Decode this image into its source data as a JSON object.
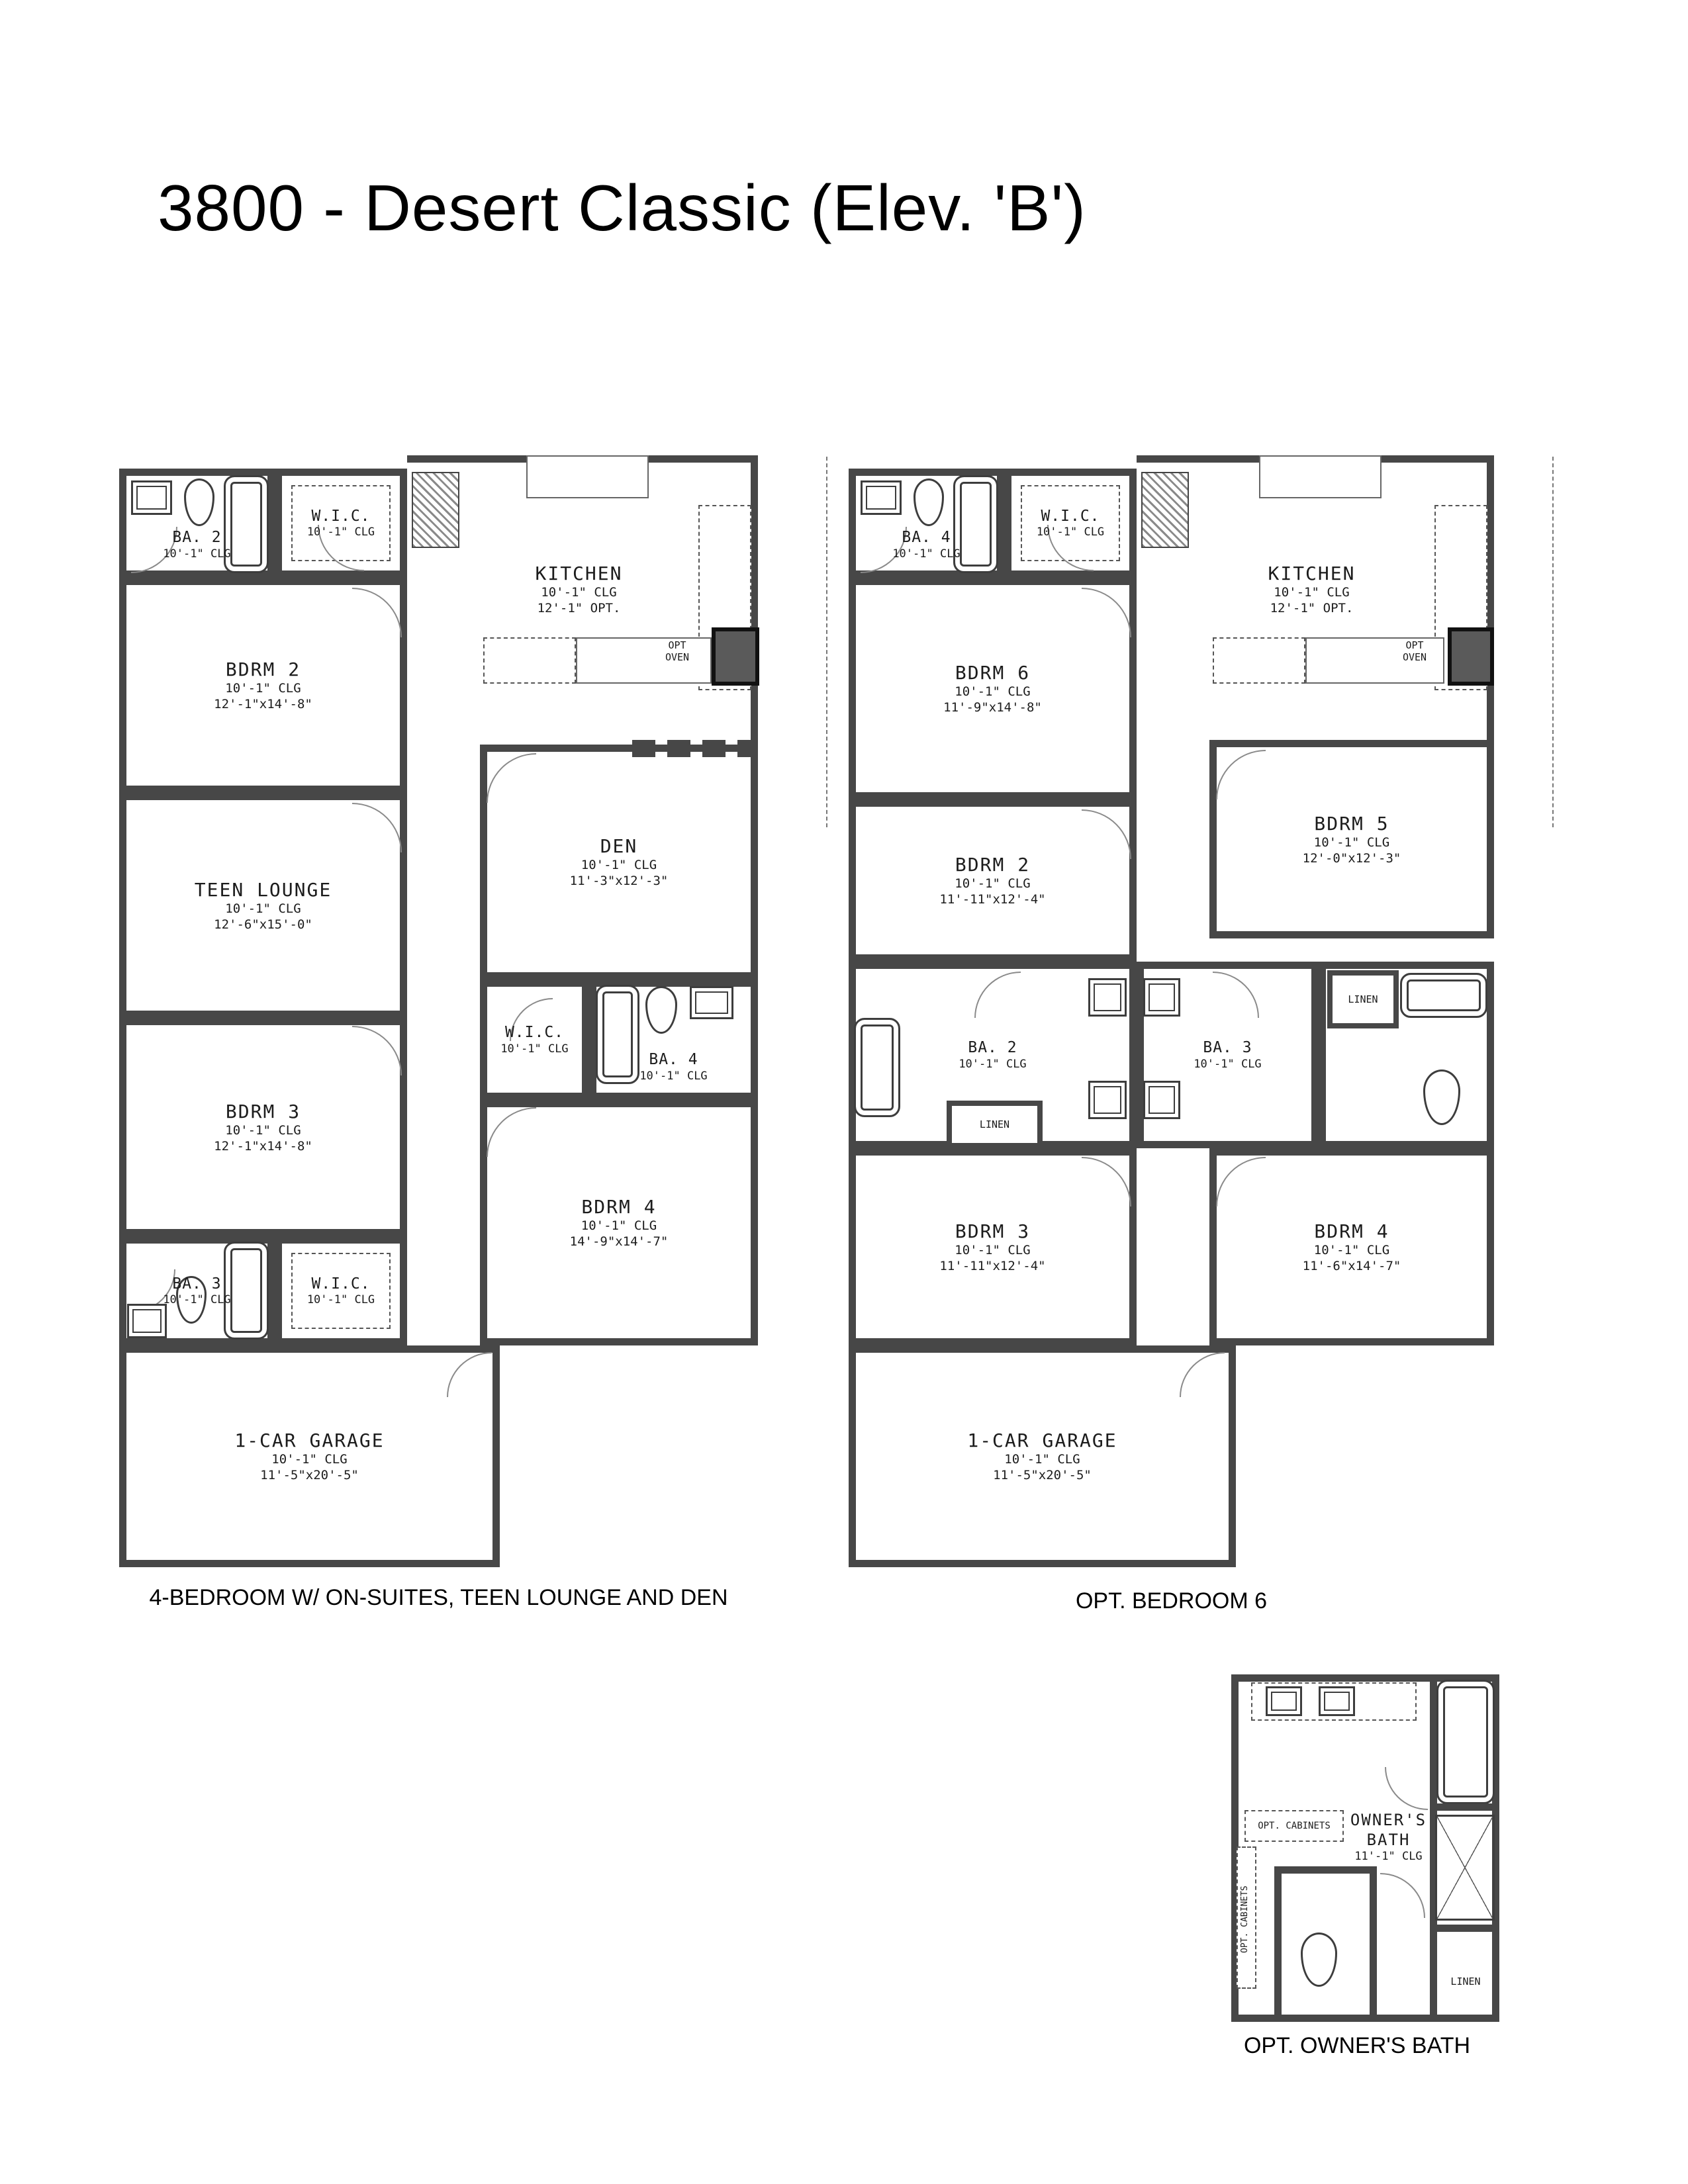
{
  "page": {
    "title": "3800 - Desert Classic (Elev. 'B')"
  },
  "plans": [
    {
      "caption": "4-BEDROOM W/ ON-SUITES, TEEN LOUNGE AND DEN",
      "rooms": {
        "ba2": {
          "name": "BA. 2",
          "clg": "10'-1\" CLG"
        },
        "wic_top": {
          "name": "W.I.C.",
          "clg": "10'-1\" CLG"
        },
        "kitchen": {
          "name": "KITCHEN",
          "clg": "10'-1\" CLG",
          "dims": "12'-1\" OPT."
        },
        "opt_oven": "OPT\nOVEN",
        "bdrm2": {
          "name": "BDRM 2",
          "clg": "10'-1\" CLG",
          "dims": "12'-1\"x14'-8\""
        },
        "den": {
          "name": "DEN",
          "clg": "10'-1\" CLG",
          "dims": "11'-3\"x12'-3\""
        },
        "teen_lounge": {
          "name": "TEEN LOUNGE",
          "clg": "10'-1\" CLG",
          "dims": "12'-6\"x15'-0\""
        },
        "wic_mid": {
          "name": "W.I.C.",
          "clg": "10'-1\" CLG"
        },
        "ba4": {
          "name": "BA. 4",
          "clg": "10'-1\" CLG"
        },
        "bdrm3": {
          "name": "BDRM 3",
          "clg": "10'-1\" CLG",
          "dims": "12'-1\"x14'-8\""
        },
        "ba3": {
          "name": "BA. 3",
          "clg": "10'-1\" CLG"
        },
        "wic_bot": {
          "name": "W.I.C.",
          "clg": "10'-1\" CLG"
        },
        "bdrm4": {
          "name": "BDRM 4",
          "clg": "10'-1\" CLG",
          "dims": "14'-9\"x14'-7\""
        },
        "garage": {
          "name": "1-CAR GARAGE",
          "clg": "10'-1\" CLG",
          "dims": "11'-5\"x20'-5\""
        }
      }
    },
    {
      "caption": "OPT. BEDROOM 6",
      "rooms": {
        "ba4": {
          "name": "BA. 4",
          "clg": "10'-1\" CLG"
        },
        "wic": {
          "name": "W.I.C.",
          "clg": "10'-1\" CLG"
        },
        "kitchen": {
          "name": "KITCHEN",
          "clg": "10'-1\" CLG",
          "dims": "12'-1\" OPT."
        },
        "opt_oven": "OPT\nOVEN",
        "bdrm6": {
          "name": "BDRM 6",
          "clg": "10'-1\" CLG",
          "dims": "11'-9\"x14'-8\""
        },
        "bdrm5": {
          "name": "BDRM 5",
          "clg": "10'-1\" CLG",
          "dims": "12'-0\"x12'-3\""
        },
        "bdrm2": {
          "name": "BDRM 2",
          "clg": "10'-1\" CLG",
          "dims": "11'-11\"x12'-4\""
        },
        "ba2": {
          "name": "BA. 2",
          "clg": "10'-1\" CLG"
        },
        "linen_left": "LINEN",
        "ba3": {
          "name": "BA. 3",
          "clg": "10'-1\" CLG"
        },
        "linen_right": "LINEN",
        "bdrm3": {
          "name": "BDRM 3",
          "clg": "10'-1\" CLG",
          "dims": "11'-11\"x12'-4\""
        },
        "bdrm4": {
          "name": "BDRM 4",
          "clg": "10'-1\" CLG",
          "dims": "11'-6\"x14'-7\""
        },
        "garage": {
          "name": "1-CAR GARAGE",
          "clg": "10'-1\" CLG",
          "dims": "11'-5\"x20'-5\""
        }
      }
    },
    {
      "caption": "OPT. OWNER'S BATH",
      "rooms": {
        "owners_bath": {
          "name": "OWNER'S\nBATH",
          "clg": "11'-1\" CLG"
        },
        "opt_cabinets_top": "OPT. CABINETS",
        "opt_cabinets_left": "OPT. CABINETS",
        "linen": "LINEN"
      }
    }
  ]
}
